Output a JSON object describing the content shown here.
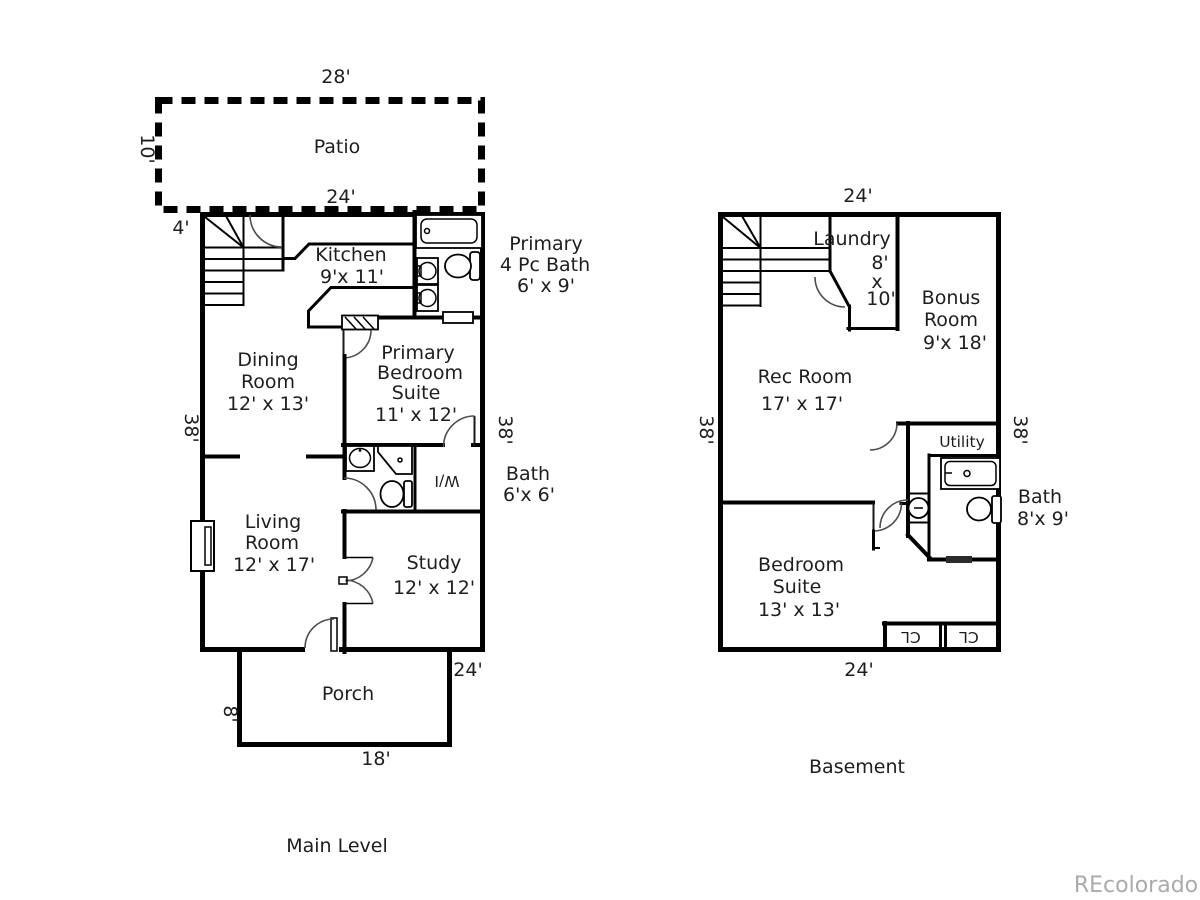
{
  "watermark": "REcolorado",
  "main_level": {
    "title": "Main Level",
    "dim_left": "38'",
    "dim_right": "38'",
    "patio": {
      "label": "Patio",
      "dim_top": "28'",
      "dim_left": "10'",
      "dim_bottom": "24'",
      "dim_offset": "4'"
    },
    "kitchen": {
      "name": "Kitchen",
      "size": "9'x 11'"
    },
    "primary_bath": {
      "line1": "Primary",
      "line2": "4 Pc Bath",
      "size": "6' x 9'"
    },
    "dining": {
      "line1": "Dining",
      "line2": "Room",
      "size": "12' x 13'"
    },
    "primary_bedroom": {
      "line1": "Primary",
      "line2": "Bedroom",
      "line3": "Suite",
      "size": "11' x 12'"
    },
    "bath": {
      "name": "Bath",
      "size": "6'x 6'"
    },
    "walk_in": {
      "label": "W/I"
    },
    "living": {
      "line1": "Living",
      "line2": "Room",
      "size": "12' x 17'"
    },
    "study": {
      "name": "Study",
      "size": "12' x 12'"
    },
    "porch": {
      "label": "Porch",
      "dim_right": "24'",
      "dim_left": "8'",
      "dim_bottom": "18'"
    }
  },
  "basement": {
    "title": "Basement",
    "dim_top": "24'",
    "dim_left": "38'",
    "dim_right": "38'",
    "dim_bottom": "24'",
    "laundry": {
      "name": "Laundry",
      "dim_w": "8'",
      "dim_sep": "x",
      "dim_l": "10'"
    },
    "bonus": {
      "line1": "Bonus",
      "line2": "Room",
      "size": "9'x 18'"
    },
    "rec_room": {
      "name": "Rec Room",
      "size": "17' x 17'"
    },
    "utility": {
      "name": "Utility"
    },
    "bath": {
      "name": "Bath",
      "size": "8'x 9'"
    },
    "bedroom": {
      "line1": "Bedroom",
      "line2": "Suite",
      "size": "13' x 13'"
    },
    "closet_left": {
      "label": "CL"
    },
    "closet_right": {
      "label": "CL"
    }
  }
}
